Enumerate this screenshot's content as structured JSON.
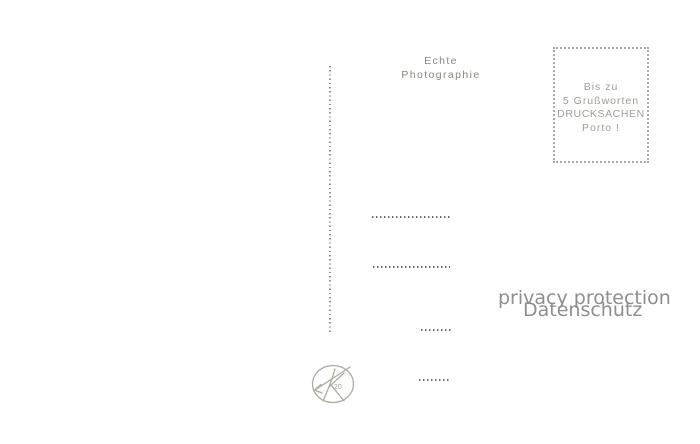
{
  "photo_note": {
    "line1": "Echte",
    "line2": "Photographie"
  },
  "stamp_box": {
    "lines": [
      "Bis zu",
      "5 Grußworten",
      "DRUCKSACHEN",
      "Porto !"
    ]
  },
  "watermark": {
    "line1": "privacy protection",
    "line2": "Datenschutz"
  },
  "logo": {
    "number": "20"
  },
  "address_lines_count": 4,
  "colors": {
    "background": "#ffffff",
    "imprint_gray": "#8b867d",
    "stamp_ink": "#9ba096",
    "stamp_border": "#a7aba0",
    "address_dots": "#6f6d68",
    "divider_dots": "#95918b",
    "watermark_gray": "#8e8e8e",
    "logo_stroke": "#a9ada1"
  }
}
